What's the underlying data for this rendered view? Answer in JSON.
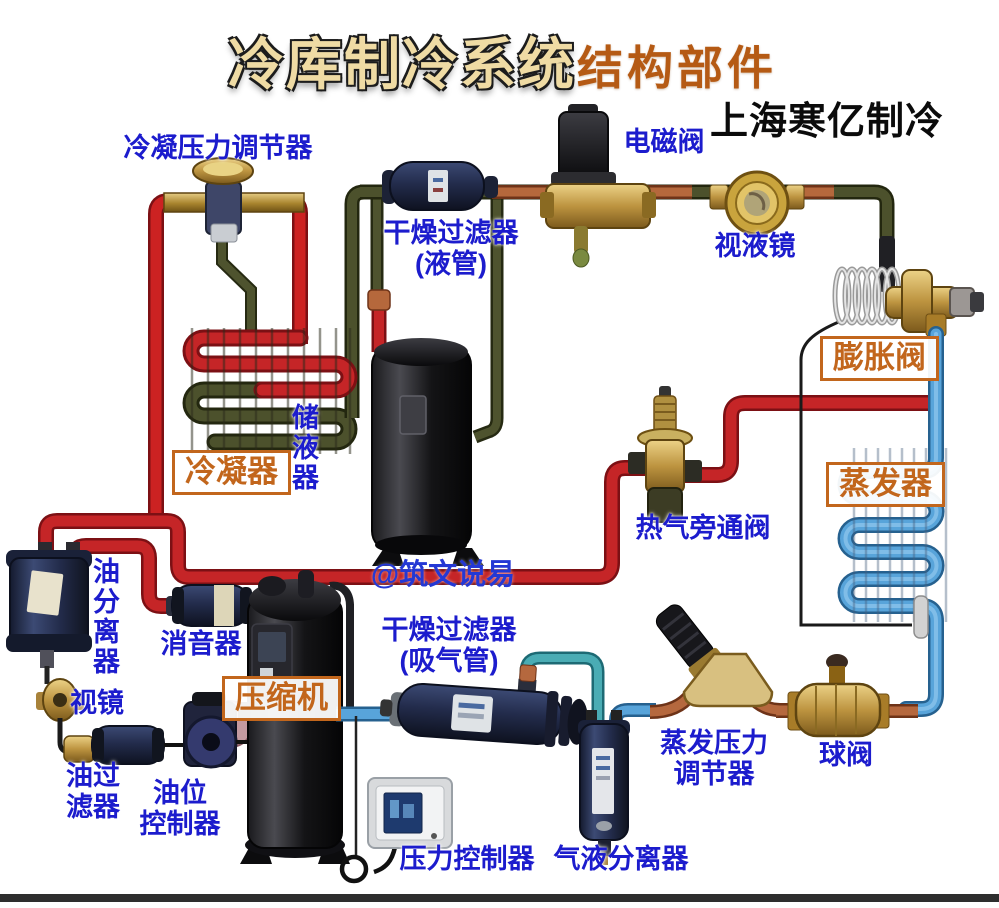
{
  "title": {
    "main": "冷库制冷系统",
    "sub": "结构部件",
    "brand": "上海寒亿制冷"
  },
  "watermark": "@筑文说易",
  "components": {
    "condensing_pressure_regulator": "冷凝压力调节器",
    "solenoid_valve": "电磁阀",
    "liquid_filter_drier": "干燥过滤器\n(液管)",
    "liquid_sight_glass": "视液镜",
    "expansion_valve": "膨胀阀",
    "evaporator": "蒸发器",
    "condenser": "冷凝器",
    "receiver": "储液器",
    "hot_gas_bypass_valve": "热气旁通阀",
    "oil_separator": "油分离器",
    "muffler": "消音器",
    "oil_sight_glass": "视镜",
    "oil_filter": "油过\n滤器",
    "oil_level_controller": "油位\n控制器",
    "compressor": "压缩机",
    "suction_filter_drier": "干燥过滤器\n(吸气管)",
    "evap_pressure_regulator": "蒸发压力\n调节器",
    "ball_valve": "球阀",
    "pressure_controller": "压力控制器",
    "gas_liquid_separator": "气液分离器"
  },
  "colors": {
    "label_blue": "#1c1ccd",
    "box_orange": "#c2661c",
    "title_cream": "#efdba4",
    "title_orange": "#b55a14",
    "pipe_red": "#c52527",
    "pipe_olive": "#4e532e",
    "pipe_blue": "#58a4da",
    "pipe_copper": "#b56a3e",
    "brass": "#c8a750",
    "component_navy": "#2a3350"
  }
}
